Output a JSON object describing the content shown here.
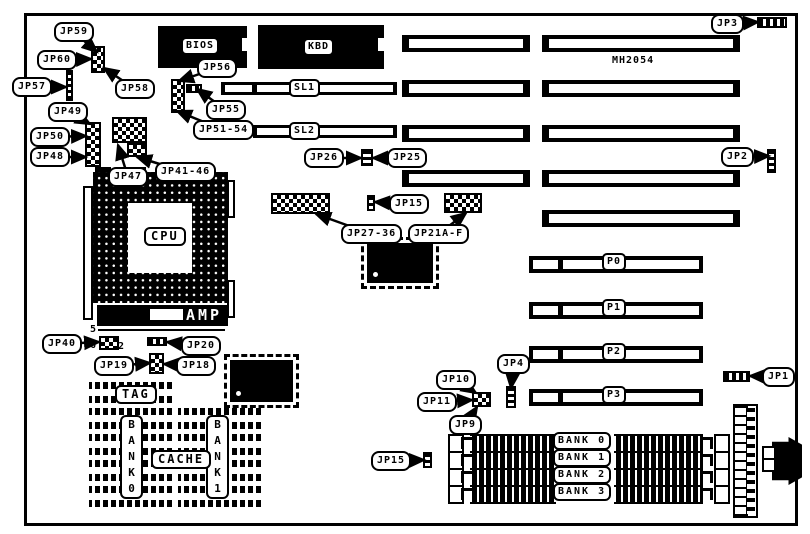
{
  "diagram": {
    "board_model": "MH2054",
    "chip_labels": {
      "bios": "BIOS",
      "kbd": "KBD",
      "cpu": "CPU",
      "amp": "AMP",
      "tag": "TAG",
      "cache": "CACHE"
    },
    "slot_labels": {
      "sl": [
        "SL1",
        "SL2"
      ],
      "p": [
        "P0",
        "P1",
        "P2",
        "P3"
      ]
    },
    "simm_banks": [
      "BANK 0",
      "BANK 1",
      "BANK 2",
      "BANK 3"
    ],
    "cache_bank_columns": [
      "BANK0",
      "BANK1"
    ],
    "pin_markers": [
      "5",
      "6",
      "2"
    ],
    "jumper_callouts": [
      {
        "text": "JP59",
        "x": 54,
        "y": 22,
        "tx": 97,
        "ty": 52
      },
      {
        "text": "JP60",
        "x": 37,
        "y": 50,
        "tx": 91,
        "ty": 59
      },
      {
        "text": "JP57",
        "x": 12,
        "y": 77,
        "tx": 66,
        "ty": 87
      },
      {
        "text": "JP58",
        "x": 115,
        "y": 79,
        "tx": 104,
        "ty": 68
      },
      {
        "text": "JP56",
        "x": 197,
        "y": 58,
        "tx": 179,
        "ty": 81
      },
      {
        "text": "JP55",
        "x": 206,
        "y": 100,
        "tx": 197,
        "ty": 89
      },
      {
        "text": "JP51-54",
        "x": 193,
        "y": 120,
        "tx": 177,
        "ty": 111
      },
      {
        "text": "JP49",
        "x": 48,
        "y": 102,
        "tx": 90,
        "ty": 124
      },
      {
        "text": "JP50",
        "x": 30,
        "y": 127,
        "tx": 86,
        "ty": 136
      },
      {
        "text": "JP48",
        "x": 30,
        "y": 147,
        "tx": 86,
        "ty": 157
      },
      {
        "text": "JP47",
        "x": 108,
        "y": 167,
        "tx": 118,
        "ty": 145
      },
      {
        "text": "JP41-46",
        "x": 155,
        "y": 162,
        "tx": 137,
        "ty": 157
      },
      {
        "text": "JP26",
        "x": 304,
        "y": 148,
        "tx": 361,
        "ty": 158
      },
      {
        "text": "JP25",
        "x": 387,
        "y": 148,
        "tx": 373,
        "ty": 158
      },
      {
        "text": "JP15",
        "x": 389,
        "y": 194,
        "tx": 375,
        "ty": 202
      },
      {
        "text": "JP27-36",
        "x": 341,
        "y": 224,
        "tx": 316,
        "ty": 214
      },
      {
        "text": "JP21A-F",
        "x": 408,
        "y": 224,
        "tx": 466,
        "ty": 213
      },
      {
        "text": "JP3",
        "x": 711,
        "y": 14,
        "tx": 758,
        "ty": 22
      },
      {
        "text": "JP2",
        "x": 721,
        "y": 147,
        "tx": 769,
        "ty": 156
      },
      {
        "text": "JP1",
        "x": 762,
        "y": 367,
        "tx": 750,
        "ty": 376
      },
      {
        "text": "JP4",
        "x": 497,
        "y": 354,
        "tx": 511,
        "ty": 388
      },
      {
        "text": "JP40",
        "x": 42,
        "y": 334,
        "tx": 99,
        "ty": 342
      },
      {
        "text": "JP20",
        "x": 181,
        "y": 336,
        "tx": 167,
        "ty": 342
      },
      {
        "text": "JP19",
        "x": 94,
        "y": 356,
        "tx": 150,
        "ty": 363
      },
      {
        "text": "JP18",
        "x": 176,
        "y": 356,
        "tx": 164,
        "ty": 364
      },
      {
        "text": "JP10",
        "x": 436,
        "y": 370,
        "tx": 476,
        "ty": 393
      },
      {
        "text": "JP11",
        "x": 417,
        "y": 392,
        "tx": 472,
        "ty": 400
      },
      {
        "text": "JP9",
        "x": 449,
        "y": 415,
        "tx": 477,
        "ty": 407
      },
      {
        "text": "JP15",
        "x": 371,
        "y": 451,
        "tx": 424,
        "ty": 460
      }
    ]
  },
  "colors": {
    "ink": "#000000",
    "paper": "#ffffff"
  }
}
